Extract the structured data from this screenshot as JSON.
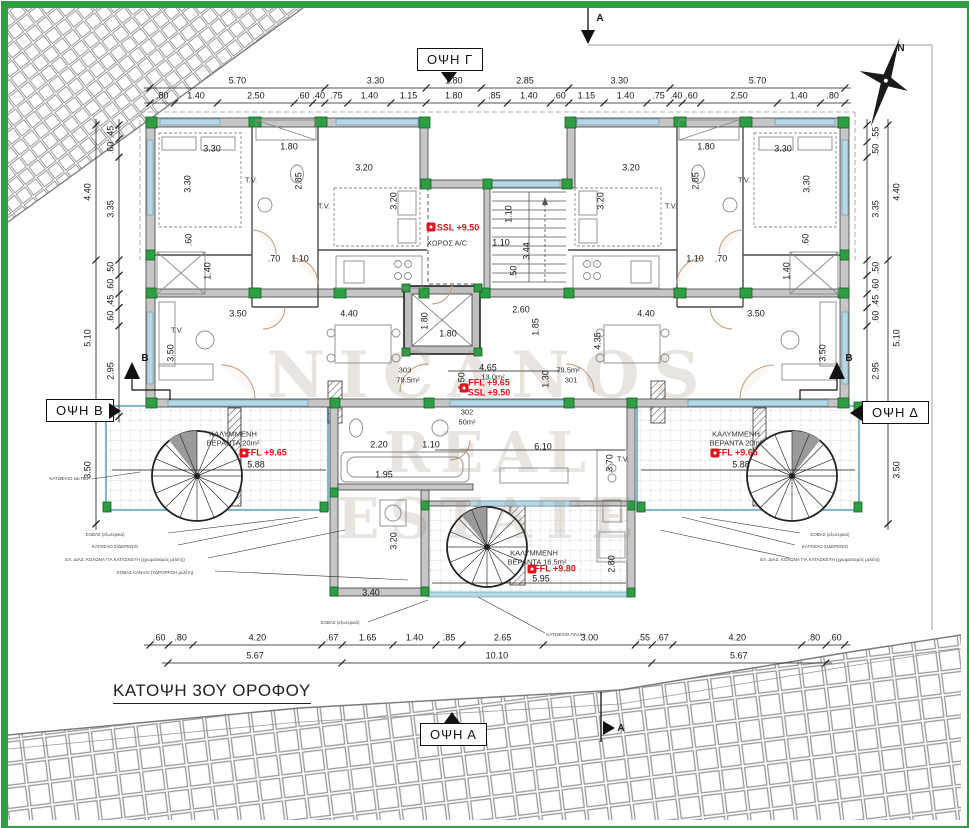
{
  "title": "ΚΑΤΟΨΗ 3ΟΥ ΟΡΟΦΟΥ",
  "elevations": {
    "top": "ΟΨΗ Γ",
    "bottom": "ΟΨΗ Α",
    "left": "ΟΨΗ Β",
    "right": "ΟΨΗ Δ"
  },
  "watermark": {
    "line1": "NICANOS",
    "line2": "REAL ESTATE"
  },
  "colors": {
    "border_green": "#2f9e3f",
    "column_green": "#2e9e44",
    "wall_gray": "#c6c6c6",
    "window_blue": "#b7d6e6",
    "level_red": "#e3131b",
    "door_tan": "#c49a7a"
  },
  "dim_lines": [
    {
      "name": "top-row-1",
      "axis": "h",
      "x": 150,
      "y": 88,
      "off": -7,
      "values": [
        "5.70",
        "3.30",
        "1.80",
        "2.85",
        "3.30",
        "5.70"
      ]
    },
    {
      "name": "top-row-2",
      "axis": "h",
      "x": 150,
      "y": 103,
      "off": -7,
      "values": [
        ".80",
        "1.40",
        "2.50",
        ".60",
        ".40",
        ".75",
        "1.40",
        "1.15",
        "1.80",
        ".85",
        "1.40",
        ".60",
        "1.15",
        "1.40",
        ".75",
        ".40",
        ".60",
        "2.50",
        "1.40",
        ".80"
      ]
    },
    {
      "name": "bottom-row-1",
      "axis": "h",
      "x": 150,
      "y": 645,
      "off": -7,
      "values": [
        ".60",
        ".80",
        "4.20",
        ".67",
        "1.65",
        "1.40",
        ".85",
        "2.65",
        "3.00",
        ".55",
        ".67",
        "4.20",
        ".80",
        ".60"
      ]
    },
    {
      "name": "bottom-row-2",
      "axis": "h",
      "x": 168,
      "y": 663,
      "off": -7,
      "values": [
        "5.67",
        "10.10",
        "5.67"
      ]
    },
    {
      "name": "left-outer",
      "axis": "v",
      "x": 96,
      "y": 125,
      "off": -8,
      "values": [
        "4.40",
        "5.10",
        "3.50"
      ]
    },
    {
      "name": "left-inner",
      "axis": "v",
      "x": 119,
      "y": 125,
      "off": -8,
      "values": [
        ".45",
        ".60",
        "3.35",
        ".50",
        ".60",
        ".45",
        ".60",
        "2.95"
      ]
    },
    {
      "name": "right-outer",
      "axis": "v",
      "x": 888,
      "y": 125,
      "off": 9,
      "values": [
        "4.40",
        "5.10",
        "3.50"
      ]
    },
    {
      "name": "right-inner",
      "axis": "v",
      "x": 867,
      "y": 125,
      "off": 9,
      "values": [
        ".55",
        ".50",
        "3.35",
        ".50",
        ".60",
        ".45",
        ".60",
        "2.95"
      ]
    }
  ],
  "labels": [
    {
      "t": "3.30",
      "x": 212,
      "y": 149,
      "c": "dim"
    },
    {
      "t": "1.80",
      "x": 289,
      "y": 147,
      "c": "dim"
    },
    {
      "t": "3.30",
      "x": 188,
      "y": 184,
      "r": -90,
      "c": "dim"
    },
    {
      "t": "2.85",
      "x": 299,
      "y": 181,
      "r": -90,
      "c": "dim"
    },
    {
      "t": "3.20",
      "x": 364,
      "y": 168,
      "c": "dim"
    },
    {
      "t": "3.20",
      "x": 394,
      "y": 201,
      "r": -90,
      "c": "dim"
    },
    {
      "t": ".70",
      "x": 274,
      "y": 259,
      "c": "dim"
    },
    {
      "t": "1.10",
      "x": 300,
      "y": 259,
      "c": "dim"
    },
    {
      "t": "1.40",
      "x": 208,
      "y": 271,
      "r": -90,
      "c": "dim"
    },
    {
      "t": ".60",
      "x": 189,
      "y": 240,
      "r": -90,
      "c": "dim"
    },
    {
      "t": "3.30",
      "x": 783,
      "y": 149,
      "c": "dim"
    },
    {
      "t": "1.80",
      "x": 706,
      "y": 147,
      "c": "dim"
    },
    {
      "t": "3.30",
      "x": 807,
      "y": 184,
      "r": -90,
      "c": "dim"
    },
    {
      "t": "2.85",
      "x": 696,
      "y": 181,
      "r": -90,
      "c": "dim"
    },
    {
      "t": "3.20",
      "x": 631,
      "y": 168,
      "c": "dim"
    },
    {
      "t": "3.20",
      "x": 601,
      "y": 201,
      "r": -90,
      "c": "dim"
    },
    {
      "t": ".70",
      "x": 721,
      "y": 259,
      "c": "dim"
    },
    {
      "t": "1.10",
      "x": 695,
      "y": 259,
      "c": "dim"
    },
    {
      "t": "1.40",
      "x": 787,
      "y": 271,
      "r": -90,
      "c": "dim"
    },
    {
      "t": ".60",
      "x": 806,
      "y": 240,
      "r": -90,
      "c": "dim"
    },
    {
      "t": "1.10",
      "x": 509,
      "y": 214,
      "r": -90,
      "c": "dim"
    },
    {
      "t": "1.10",
      "x": 501,
      "y": 243,
      "c": "dim"
    },
    {
      "t": "3.44",
      "x": 527,
      "y": 251,
      "r": -90,
      "c": "dim"
    },
    {
      "t": ".50",
      "x": 514,
      "y": 272,
      "r": -90,
      "c": "dim"
    },
    {
      "t": "2.60",
      "x": 521,
      "y": 310,
      "c": "dim"
    },
    {
      "t": "1.85",
      "x": 536,
      "y": 327,
      "r": -90,
      "c": "dim"
    },
    {
      "t": "1.80",
      "x": 425,
      "y": 321,
      "r": -90,
      "c": "dim"
    },
    {
      "t": "1.80",
      "x": 448,
      "y": 334,
      "c": "dim"
    },
    {
      "t": "4.65",
      "x": 488,
      "y": 368,
      "c": "dim"
    },
    {
      "t": "1.50",
      "x": 462,
      "y": 381,
      "r": -90,
      "c": "dim"
    },
    {
      "t": "1.30",
      "x": 546,
      "y": 379,
      "r": -90,
      "c": "dim"
    },
    {
      "t": "4.35",
      "x": 598,
      "y": 341,
      "r": -90,
      "c": "dim"
    },
    {
      "t": "3.50",
      "x": 238,
      "y": 314,
      "c": "dim"
    },
    {
      "t": "4.40",
      "x": 349,
      "y": 314,
      "c": "dim"
    },
    {
      "t": "4.40",
      "x": 646,
      "y": 314,
      "c": "dim"
    },
    {
      "t": "3.50",
      "x": 756,
      "y": 314,
      "c": "dim"
    },
    {
      "t": "3.50",
      "x": 171,
      "y": 353,
      "r": -90,
      "c": "dim"
    },
    {
      "t": "3.50",
      "x": 823,
      "y": 353,
      "r": -90,
      "c": "dim"
    },
    {
      "t": "2.20",
      "x": 379,
      "y": 445,
      "c": "dim"
    },
    {
      "t": "1.10",
      "x": 431,
      "y": 445,
      "c": "dim"
    },
    {
      "t": "6.10",
      "x": 543,
      "y": 447,
      "c": "dim"
    },
    {
      "t": "3.70",
      "x": 610,
      "y": 463,
      "r": -90,
      "c": "dim"
    },
    {
      "t": "1.95",
      "x": 384,
      "y": 475,
      "c": "dim"
    },
    {
      "t": "3.20",
      "x": 394,
      "y": 541,
      "r": -90,
      "c": "dim"
    },
    {
      "t": "3.40",
      "x": 371,
      "y": 593,
      "c": "dim"
    },
    {
      "t": "2.80",
      "x": 612,
      "y": 564,
      "r": -90,
      "c": "dim"
    },
    {
      "t": "5.95",
      "x": 541,
      "y": 579,
      "c": "dim"
    },
    {
      "t": "5.88",
      "x": 256,
      "y": 465,
      "c": "dim"
    },
    {
      "t": "5.88",
      "x": 741,
      "y": 465,
      "c": "dim"
    },
    {
      "t": "303",
      "x": 405,
      "y": 370,
      "c": "room"
    },
    {
      "t": "79.5m²",
      "x": 408,
      "y": 380,
      "c": "room"
    },
    {
      "t": "79.5m²",
      "x": 568,
      "y": 370,
      "c": "room"
    },
    {
      "t": "301",
      "x": 571,
      "y": 380,
      "c": "room"
    },
    {
      "t": "13.0m²",
      "x": 493,
      "y": 377,
      "c": "room"
    },
    {
      "t": "302",
      "x": 467,
      "y": 412,
      "c": "room"
    },
    {
      "t": "50m²",
      "x": 467,
      "y": 422,
      "c": "room"
    },
    {
      "t": "ΧΩΡΟΣ Α/C",
      "x": 447,
      "y": 243,
      "c": "room"
    },
    {
      "t": "ΚΑΛΥΜΜΕΝΗ",
      "x": 233,
      "y": 434,
      "c": "room"
    },
    {
      "t": "ΒΕΡΑΝΤΑ 20m²",
      "x": 233,
      "y": 443,
      "c": "room"
    },
    {
      "t": "ΚΑΛΥΜΜΕΝΗ",
      "x": 736,
      "y": 434,
      "c": "room"
    },
    {
      "t": "ΒΕΡΑΝΤΑ 20m²",
      "x": 736,
      "y": 443,
      "c": "room"
    },
    {
      "t": "ΚΑΛΥΜΜΕΝΗ",
      "x": 534,
      "y": 553,
      "c": "room"
    },
    {
      "t": "ΒΕΡΑΝΤΑ 16.5m²",
      "x": 537,
      "y": 562,
      "c": "room"
    },
    {
      "t": "T.V.",
      "x": 251,
      "y": 180,
      "c": "room"
    },
    {
      "t": "T.V.",
      "x": 744,
      "y": 180,
      "c": "room"
    },
    {
      "t": "T.V.",
      "x": 324,
      "y": 206,
      "c": "room"
    },
    {
      "t": "T.V.",
      "x": 671,
      "y": 206,
      "c": "room"
    },
    {
      "t": "T.V.",
      "x": 623,
      "y": 459,
      "c": "room"
    },
    {
      "t": "T.V.",
      "x": 177,
      "y": 330,
      "c": "room"
    },
    {
      "t": "SSL +9.50",
      "x": 458,
      "y": 228,
      "c": "red"
    },
    {
      "t": "FFL +9.65",
      "x": 489,
      "y": 383,
      "c": "red"
    },
    {
      "t": "SSL +9.50",
      "x": 489,
      "y": 393,
      "c": "red"
    },
    {
      "t": "FFL +9.65",
      "x": 266,
      "y": 453,
      "c": "red"
    },
    {
      "t": "FFL +9.65",
      "x": 737,
      "y": 453,
      "c": "red"
    },
    {
      "t": "FFL +9.80",
      "x": 555,
      "y": 569,
      "c": "red"
    },
    {
      "t": "ΚΑΤΩΦΛΙΟ και ΠΕΡ.",
      "x": 70,
      "y": 479,
      "c": "tiny"
    },
    {
      "t": "ΣΟΒΑΣ (εξωτερικά)",
      "x": 105,
      "y": 535,
      "c": "tiny"
    },
    {
      "t": "ΚΑΓΚΕΛΟ ΣΙΔΕΡΕΝΙΟ",
      "x": 115,
      "y": 547,
      "c": "tiny"
    },
    {
      "t": "ΕΛ. ΔΙΑΖ. ΚΟΛΩΝΑ ΓΙΑ ΚΑΤΑΣΚΕΥΗ (χρωματισμός μελέτη)",
      "x": 125,
      "y": 560,
      "c": "tiny"
    },
    {
      "t": "ΣΟΒΑΣ ΚΑΝΑΛΙ (ΥΔΡΟΡΡΟΗ μελέτη)",
      "x": 155,
      "y": 573,
      "c": "tiny"
    },
    {
      "t": "ΣΟΒΑΣ (εξωτερικά)",
      "x": 830,
      "y": 535,
      "c": "tiny"
    },
    {
      "t": "ΚΑΓΚΕΛΟ ΣΙΔΕΡΕΝΙΟ",
      "x": 825,
      "y": 547,
      "c": "tiny"
    },
    {
      "t": "ΕΛ. ΔΙΑΖ. ΚΟΛΩΝΑ ΓΙΑ ΚΑΤΑΣΚΕΥΗ (χρωματισμός μελέτη)",
      "x": 820,
      "y": 560,
      "c": "tiny"
    },
    {
      "t": "ΣΟΒΑΣ (εξωτερικά)",
      "x": 340,
      "y": 623,
      "c": "tiny"
    },
    {
      "t": "ΚΑΤΩΦΛΙΟ ΠΛΑΚΑ",
      "x": 566,
      "y": 635,
      "c": "tiny"
    },
    {
      "t": "A",
      "x": 600,
      "y": 19,
      "c": "sec"
    },
    {
      "t": "A",
      "x": 621,
      "y": 729,
      "c": "sec"
    },
    {
      "t": "B",
      "x": 145,
      "y": 359,
      "c": "sec"
    },
    {
      "t": "B",
      "x": 849,
      "y": 359,
      "c": "sec"
    },
    {
      "t": "N",
      "x": 901,
      "y": 49,
      "c": "sec"
    }
  ],
  "level_markers": [
    {
      "x": 431,
      "y": 227
    },
    {
      "x": 464,
      "y": 388
    },
    {
      "x": 244,
      "y": 453
    },
    {
      "x": 715,
      "y": 453
    },
    {
      "x": 532,
      "y": 569
    }
  ]
}
